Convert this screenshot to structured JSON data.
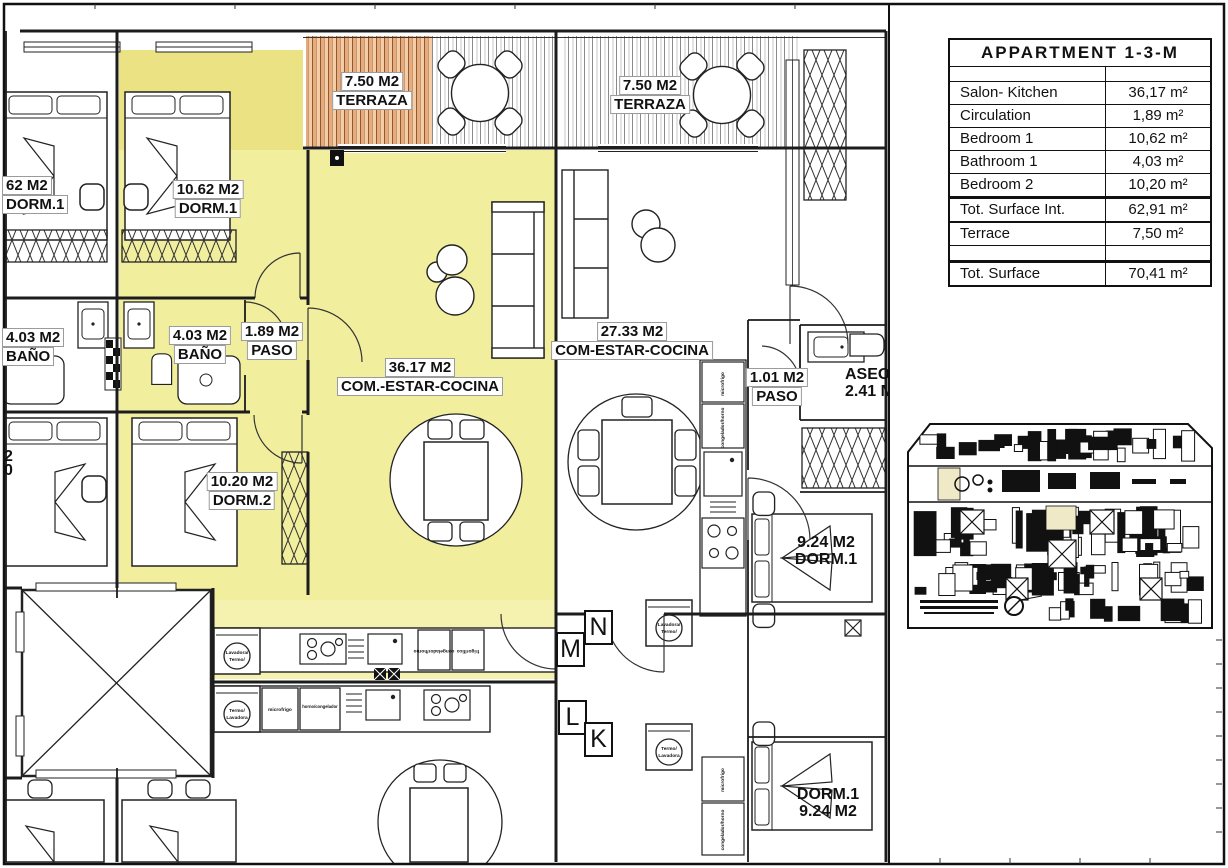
{
  "colors": {
    "highlight": "#f1ee9e",
    "highlight_dark": "#ebe283",
    "deck_orange": "#eab183",
    "ink": "#1c1c1c"
  },
  "area_table": {
    "title": "APPARTMENT 1-3-M",
    "rows": [
      {
        "label": "Salon- Kitchen",
        "value": "36,17 m²"
      },
      {
        "label": "Circulation",
        "value": "1,89 m²"
      },
      {
        "label": "Bedroom 1",
        "value": "10,62 m²"
      },
      {
        "label": "Bathroom 1",
        "value": "4,03 m²"
      },
      {
        "label": "Bedroom 2",
        "value": "10,20 m²"
      },
      {
        "label": "Tot. Surface Int.",
        "value": "62,91 m²"
      },
      {
        "label": "Terrace",
        "value": "7,50 m²"
      },
      {
        "label": "Tot. Surface",
        "value": "70,41 m²"
      }
    ]
  },
  "rooms": {
    "terrace_left": {
      "area": "7.50 M2",
      "name": "TERRAZA"
    },
    "terrace_right": {
      "area": "7.50 M2",
      "name": "TERRAZA"
    },
    "dorm1_left_cut": {
      "area": "62 M2",
      "name": "DORM.1"
    },
    "dorm1_main": {
      "area": "10.62 M2",
      "name": "DORM.1"
    },
    "bano_left": {
      "area": "4.03 M2",
      "name": "BAÑO"
    },
    "bano_main": {
      "area": "4.03 M2",
      "name": "BAÑO"
    },
    "paso_main": {
      "area": "1.89 M2",
      "name": "PASO"
    },
    "salon_main": {
      "area": "36.17 M2",
      "name": "COM.-ESTAR-COCINA"
    },
    "salon_right": {
      "area": "27.33 M2",
      "name": "COM-ESTAR-COCINA"
    },
    "paso_right": {
      "area": "1.01 M2",
      "name": "PASO"
    },
    "aseo": {
      "area": "2.41 M2",
      "name": "ASEO"
    },
    "dorm2_main": {
      "area": "10.20 M2",
      "name": "DORM.2"
    },
    "dorm1_right": {
      "area": "9.24 M2",
      "name": "DORM.1"
    },
    "dorm1_bottom": {
      "area": "9.24 M2",
      "name": "DORM.1"
    },
    "edge_cut": {
      "area": "2",
      "name": "0"
    }
  },
  "unit_letters": {
    "n": "N",
    "m": "M",
    "l": "L",
    "k": "K"
  },
  "appliances": {
    "lavadora_termo_1": "Lavadora/",
    "lavadora_termo_2": "Termo/",
    "termo_lavadora_1": "Termo/",
    "termo_lavadora_2": "Lavadora",
    "microfrigo": "microfrigo",
    "horno_congelador": "horno/congelador",
    "congelador_horno": "congelador/horno",
    "frigorifico": "frigorífico"
  }
}
